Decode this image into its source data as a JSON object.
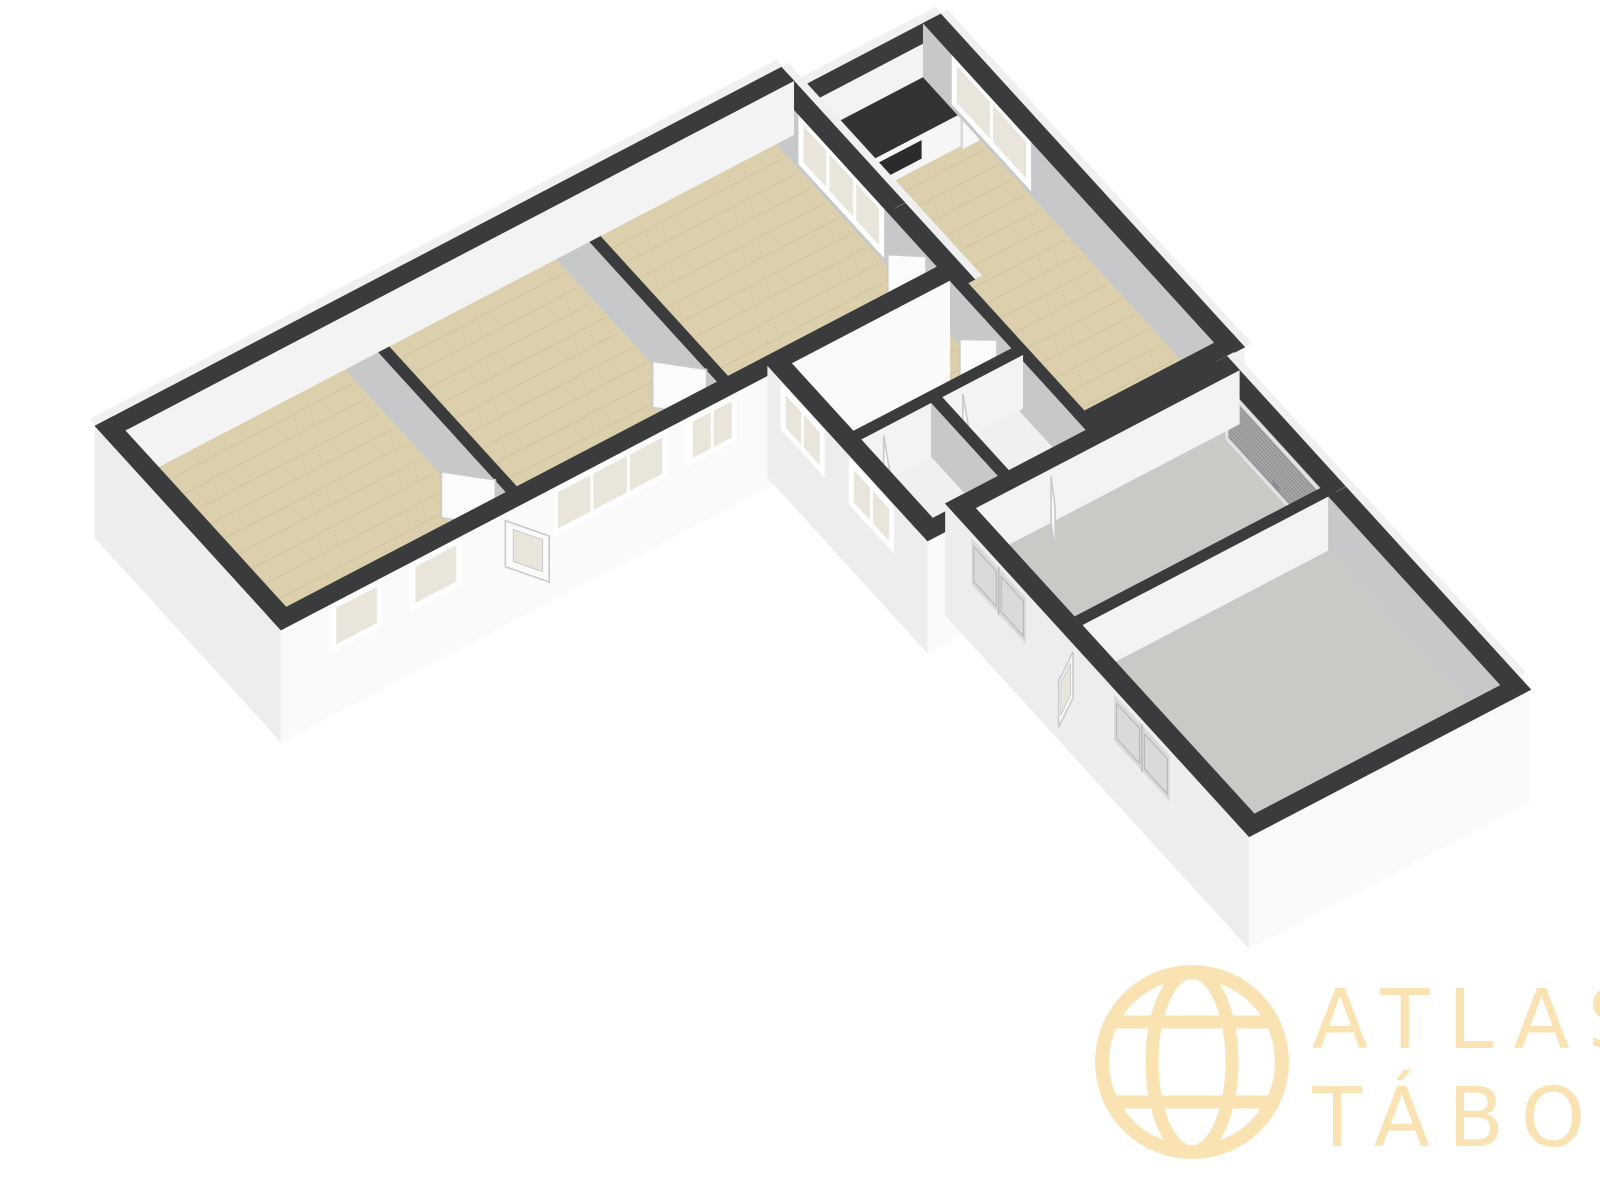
{
  "logo": {
    "line1": "ATLAS",
    "line2": "TÁBOR"
  },
  "palette": {
    "background": "#ffffff",
    "wall_top": "#3a3b3d",
    "wall_bright": "#f3f3f4",
    "wall_shade": "#c7c8ca",
    "wall_exterior": "#ededee",
    "wall_exterior_bright": "#fafafa",
    "cap": "#f0f0f1",
    "floor_wood": "#dbcfac",
    "floor_wood_line": "#bfb089",
    "floor_concrete": "#c9cac6",
    "floor_light": "#eef0f1",
    "glass": "#e9e5da",
    "frame": "#ffffff",
    "door": "#fbfbfc",
    "door_edge": "#c9cacc",
    "double_door": "#d9dadc",
    "garage_door": "#a8a9ab",
    "garage_door_line": "#909193",
    "counter_top": "#323335",
    "counter_inset": "#2a2b2d",
    "logo_color": "#fae3b2"
  },
  "rooms": [
    {
      "id": "room-1",
      "floor": "wood"
    },
    {
      "id": "room-2",
      "floor": "wood"
    },
    {
      "id": "room-3",
      "floor": "wood"
    },
    {
      "id": "kitchen",
      "floor": "wood"
    },
    {
      "id": "hall",
      "floor": "wood"
    },
    {
      "id": "bathroom",
      "floor": "light"
    },
    {
      "id": "wc",
      "floor": "light"
    },
    {
      "id": "garage",
      "floor": "concrete"
    },
    {
      "id": "storage-hall",
      "floor": "concrete"
    }
  ]
}
